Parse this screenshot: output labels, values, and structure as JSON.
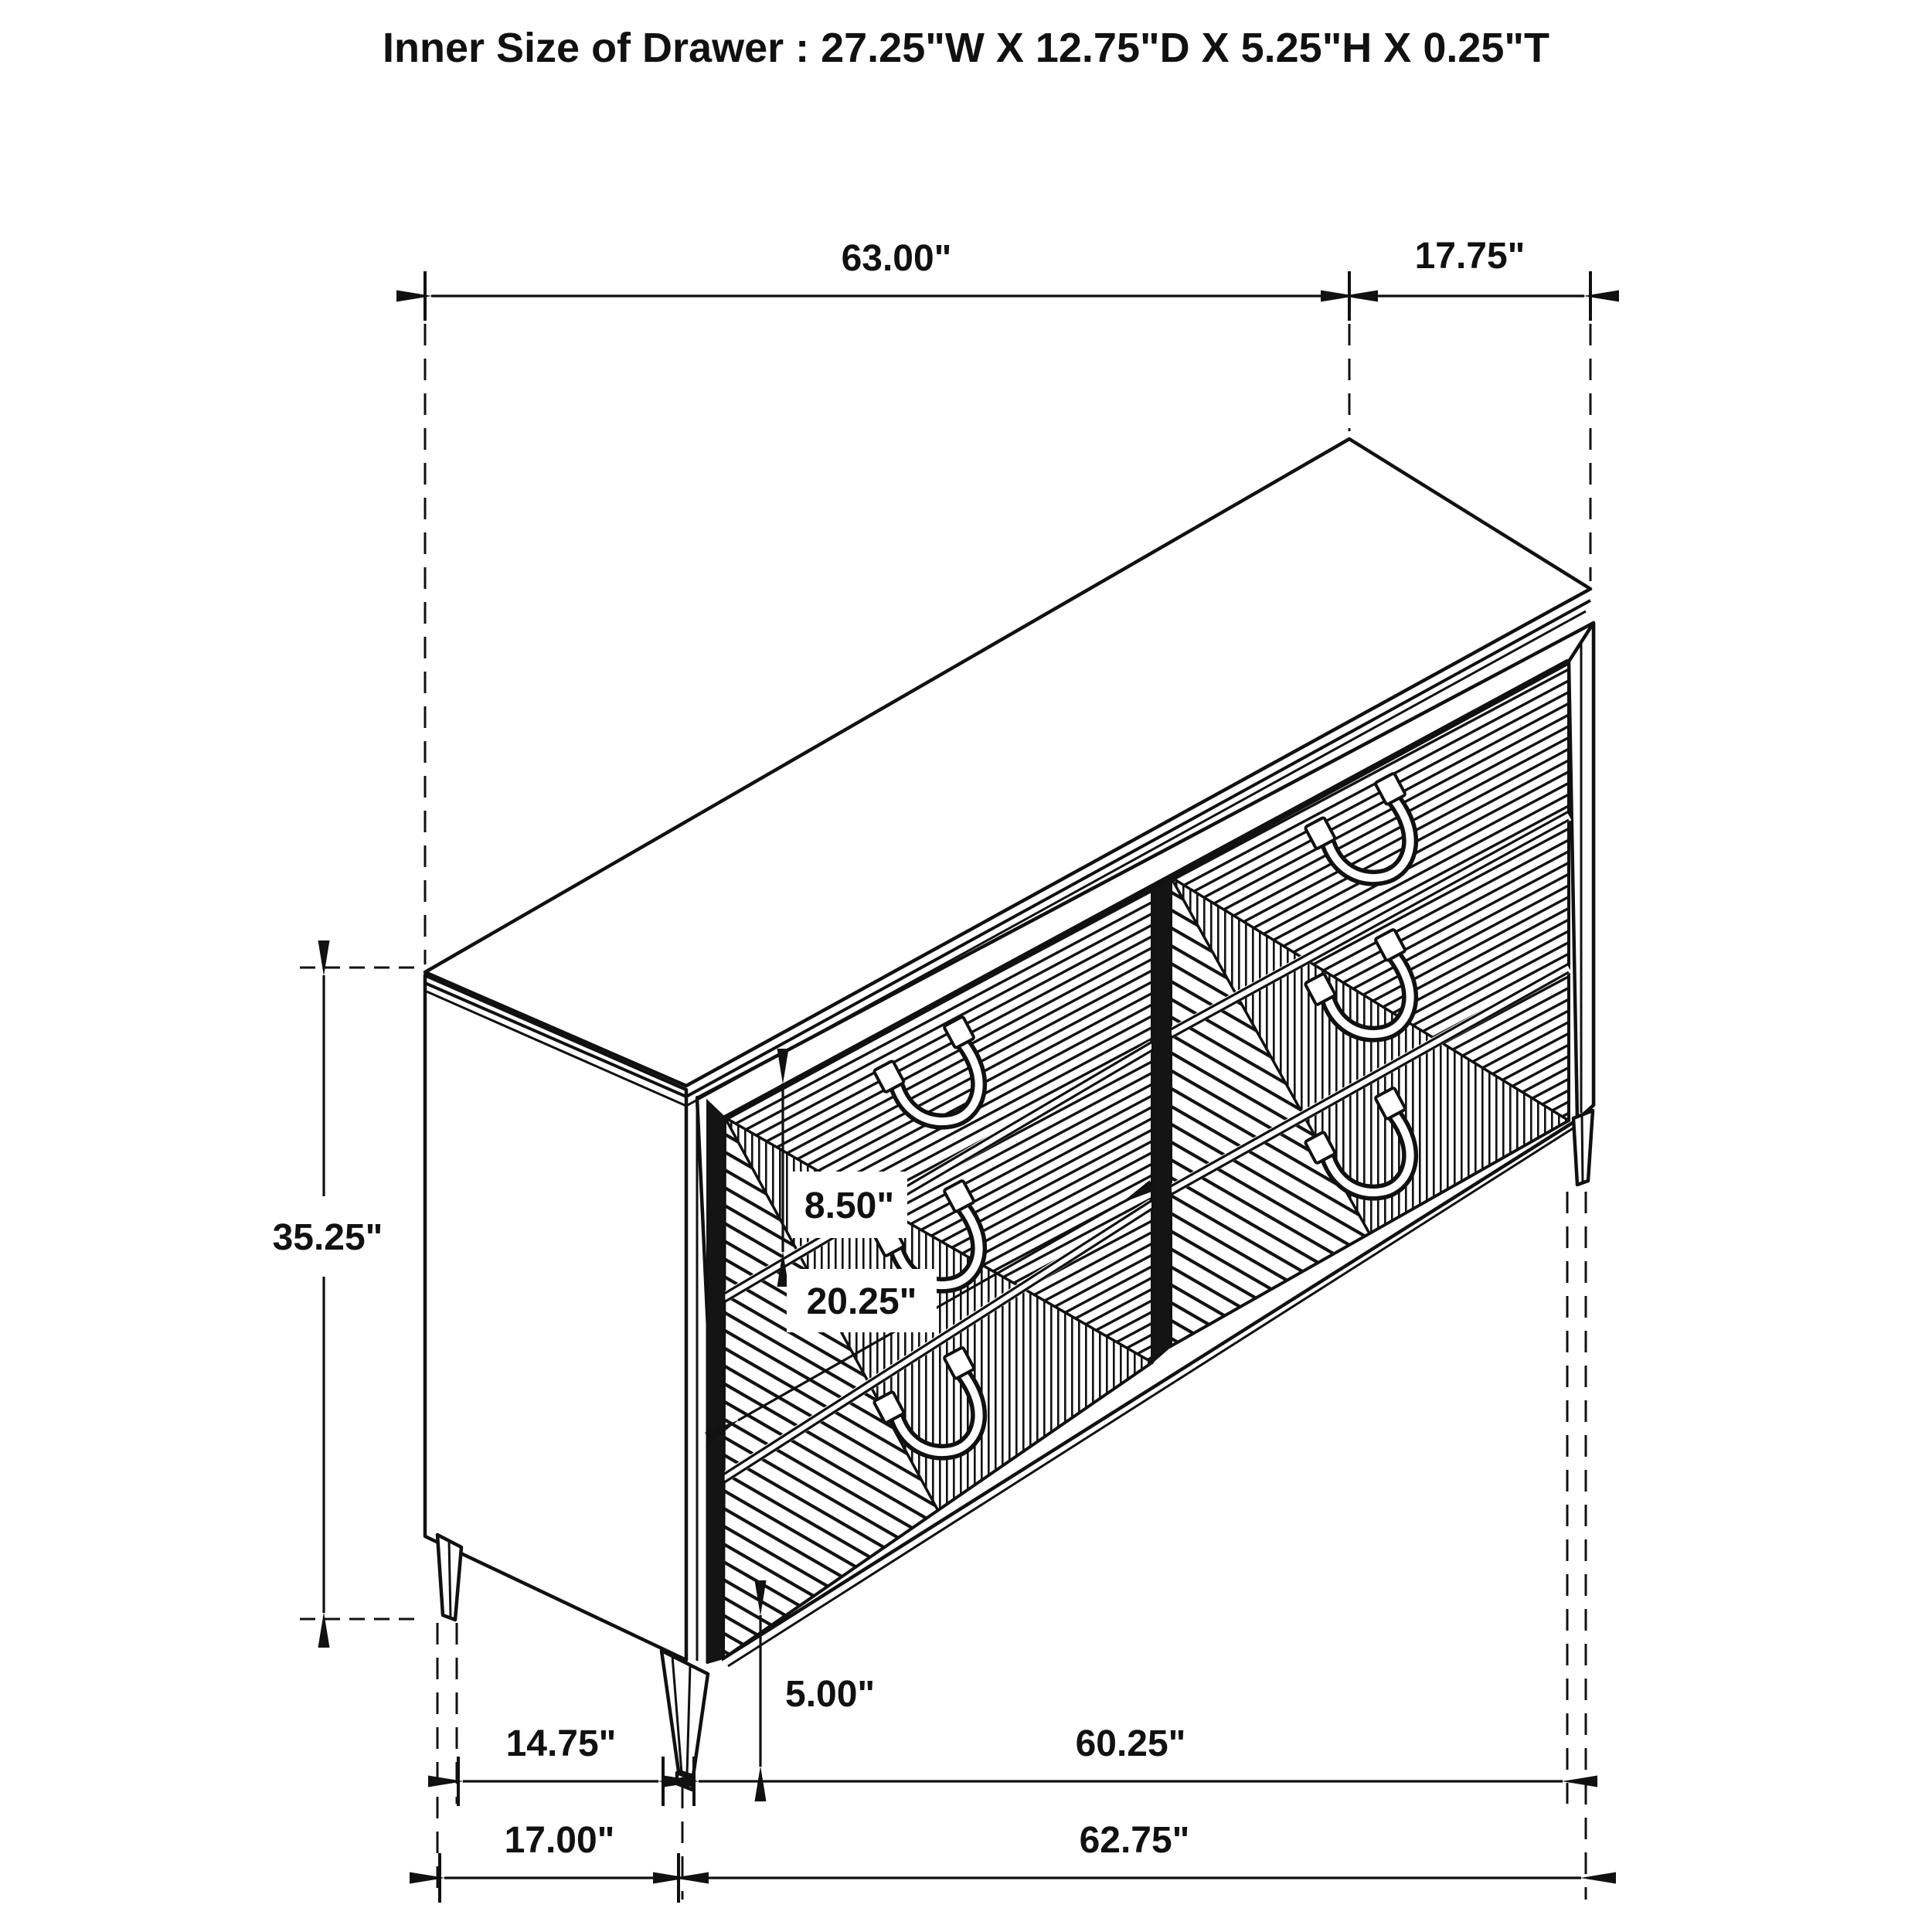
{
  "title": "Inner Size of Drawer : 27.25\"W X 12.75\"D X 5.25\"H X 0.25\"T",
  "object": "six-drawer dresser isometric technical line drawing",
  "colors": {
    "ink": "#111111",
    "background": "#ffffff"
  },
  "dimensions": {
    "top_width": "63.00\"",
    "top_depth": "17.75\"",
    "overall_height": "35.25\"",
    "drawer_front_height": "8.50\"",
    "drawer_front_width": "20.25\"",
    "leg_height": "5.00\"",
    "side_base_depth": "14.75\"",
    "front_base_width": "60.25\"",
    "base_total_depth": "17.00\"",
    "base_total_width": "62.75\""
  }
}
